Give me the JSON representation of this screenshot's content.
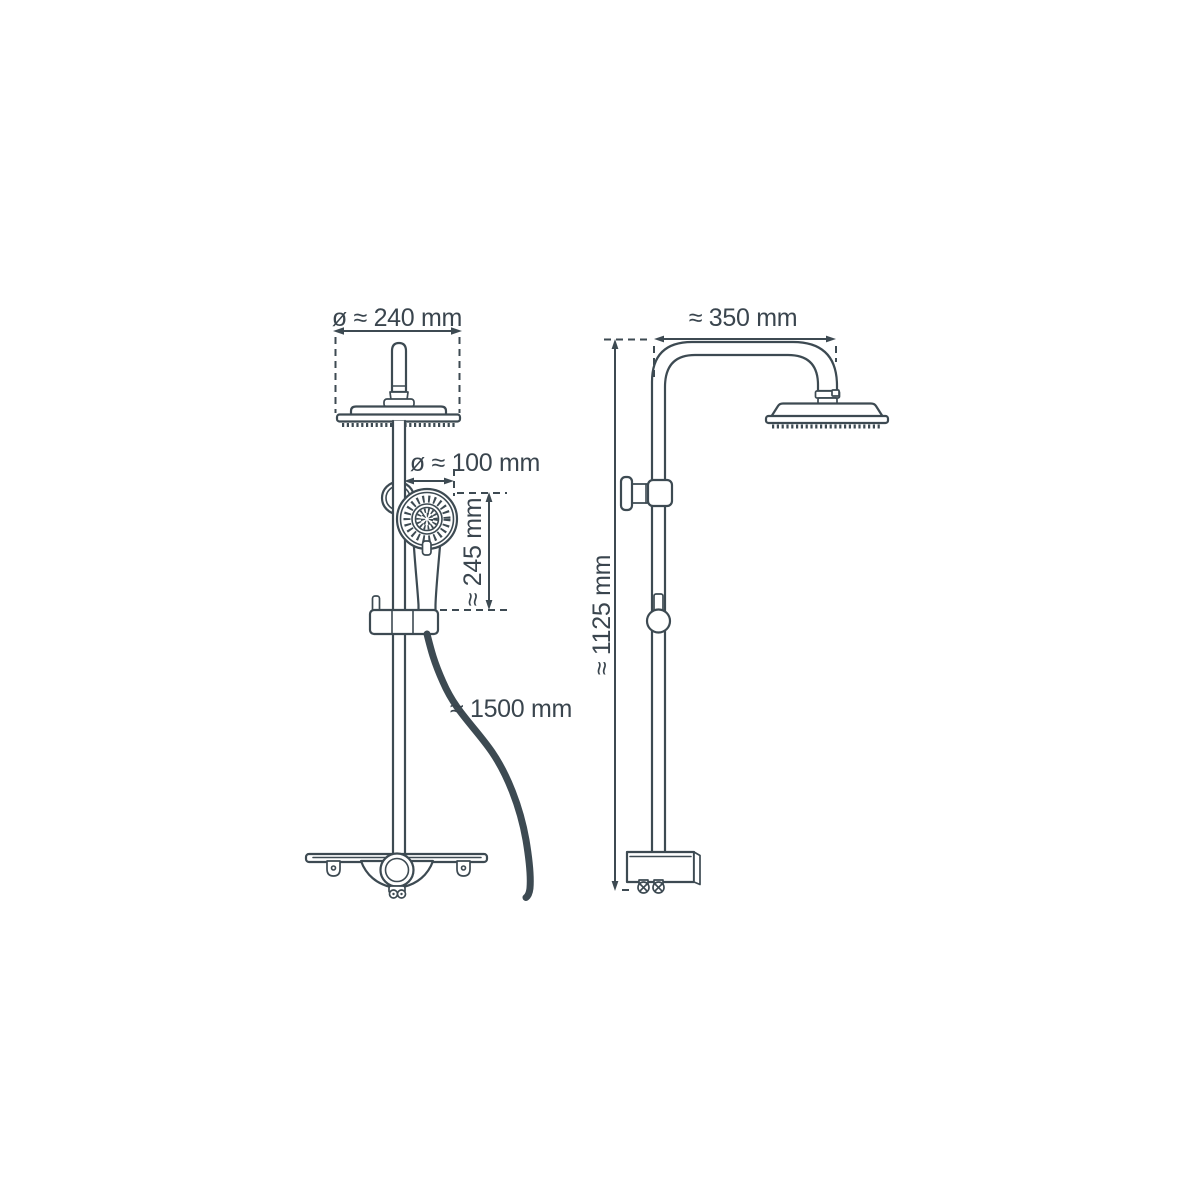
{
  "drawing": {
    "subject": "shower column technical dimension drawing",
    "line_color": "#3d4a52",
    "background_color": "#ffffff",
    "views": [
      {
        "name": "front view",
        "parts": [
          "overhead rain shower head",
          "shower column pipe",
          "hand shower holder ring",
          "hand shower",
          "slider clamp",
          "shower hose",
          "shelf with diverter knob"
        ],
        "dimensions": [
          {
            "part": "overhead shower head diameter",
            "label": "ø ≈ 240 mm"
          },
          {
            "part": "hand shower head diameter",
            "label": "ø ≈ 100 mm"
          },
          {
            "part": "hand shower length",
            "label": "≈ 245 mm"
          },
          {
            "part": "shower hose length",
            "label": "≈ 1500 mm"
          }
        ]
      },
      {
        "name": "side view",
        "parts": [
          "shower arm",
          "overhead rain shower head",
          "wall bracket",
          "slider knob",
          "mixer housing with connection nuts"
        ],
        "dimensions": [
          {
            "part": "shower arm reach",
            "label": "≈ 350 mm"
          },
          {
            "part": "shower column height",
            "label": "≈ 1125 mm"
          }
        ]
      }
    ]
  }
}
